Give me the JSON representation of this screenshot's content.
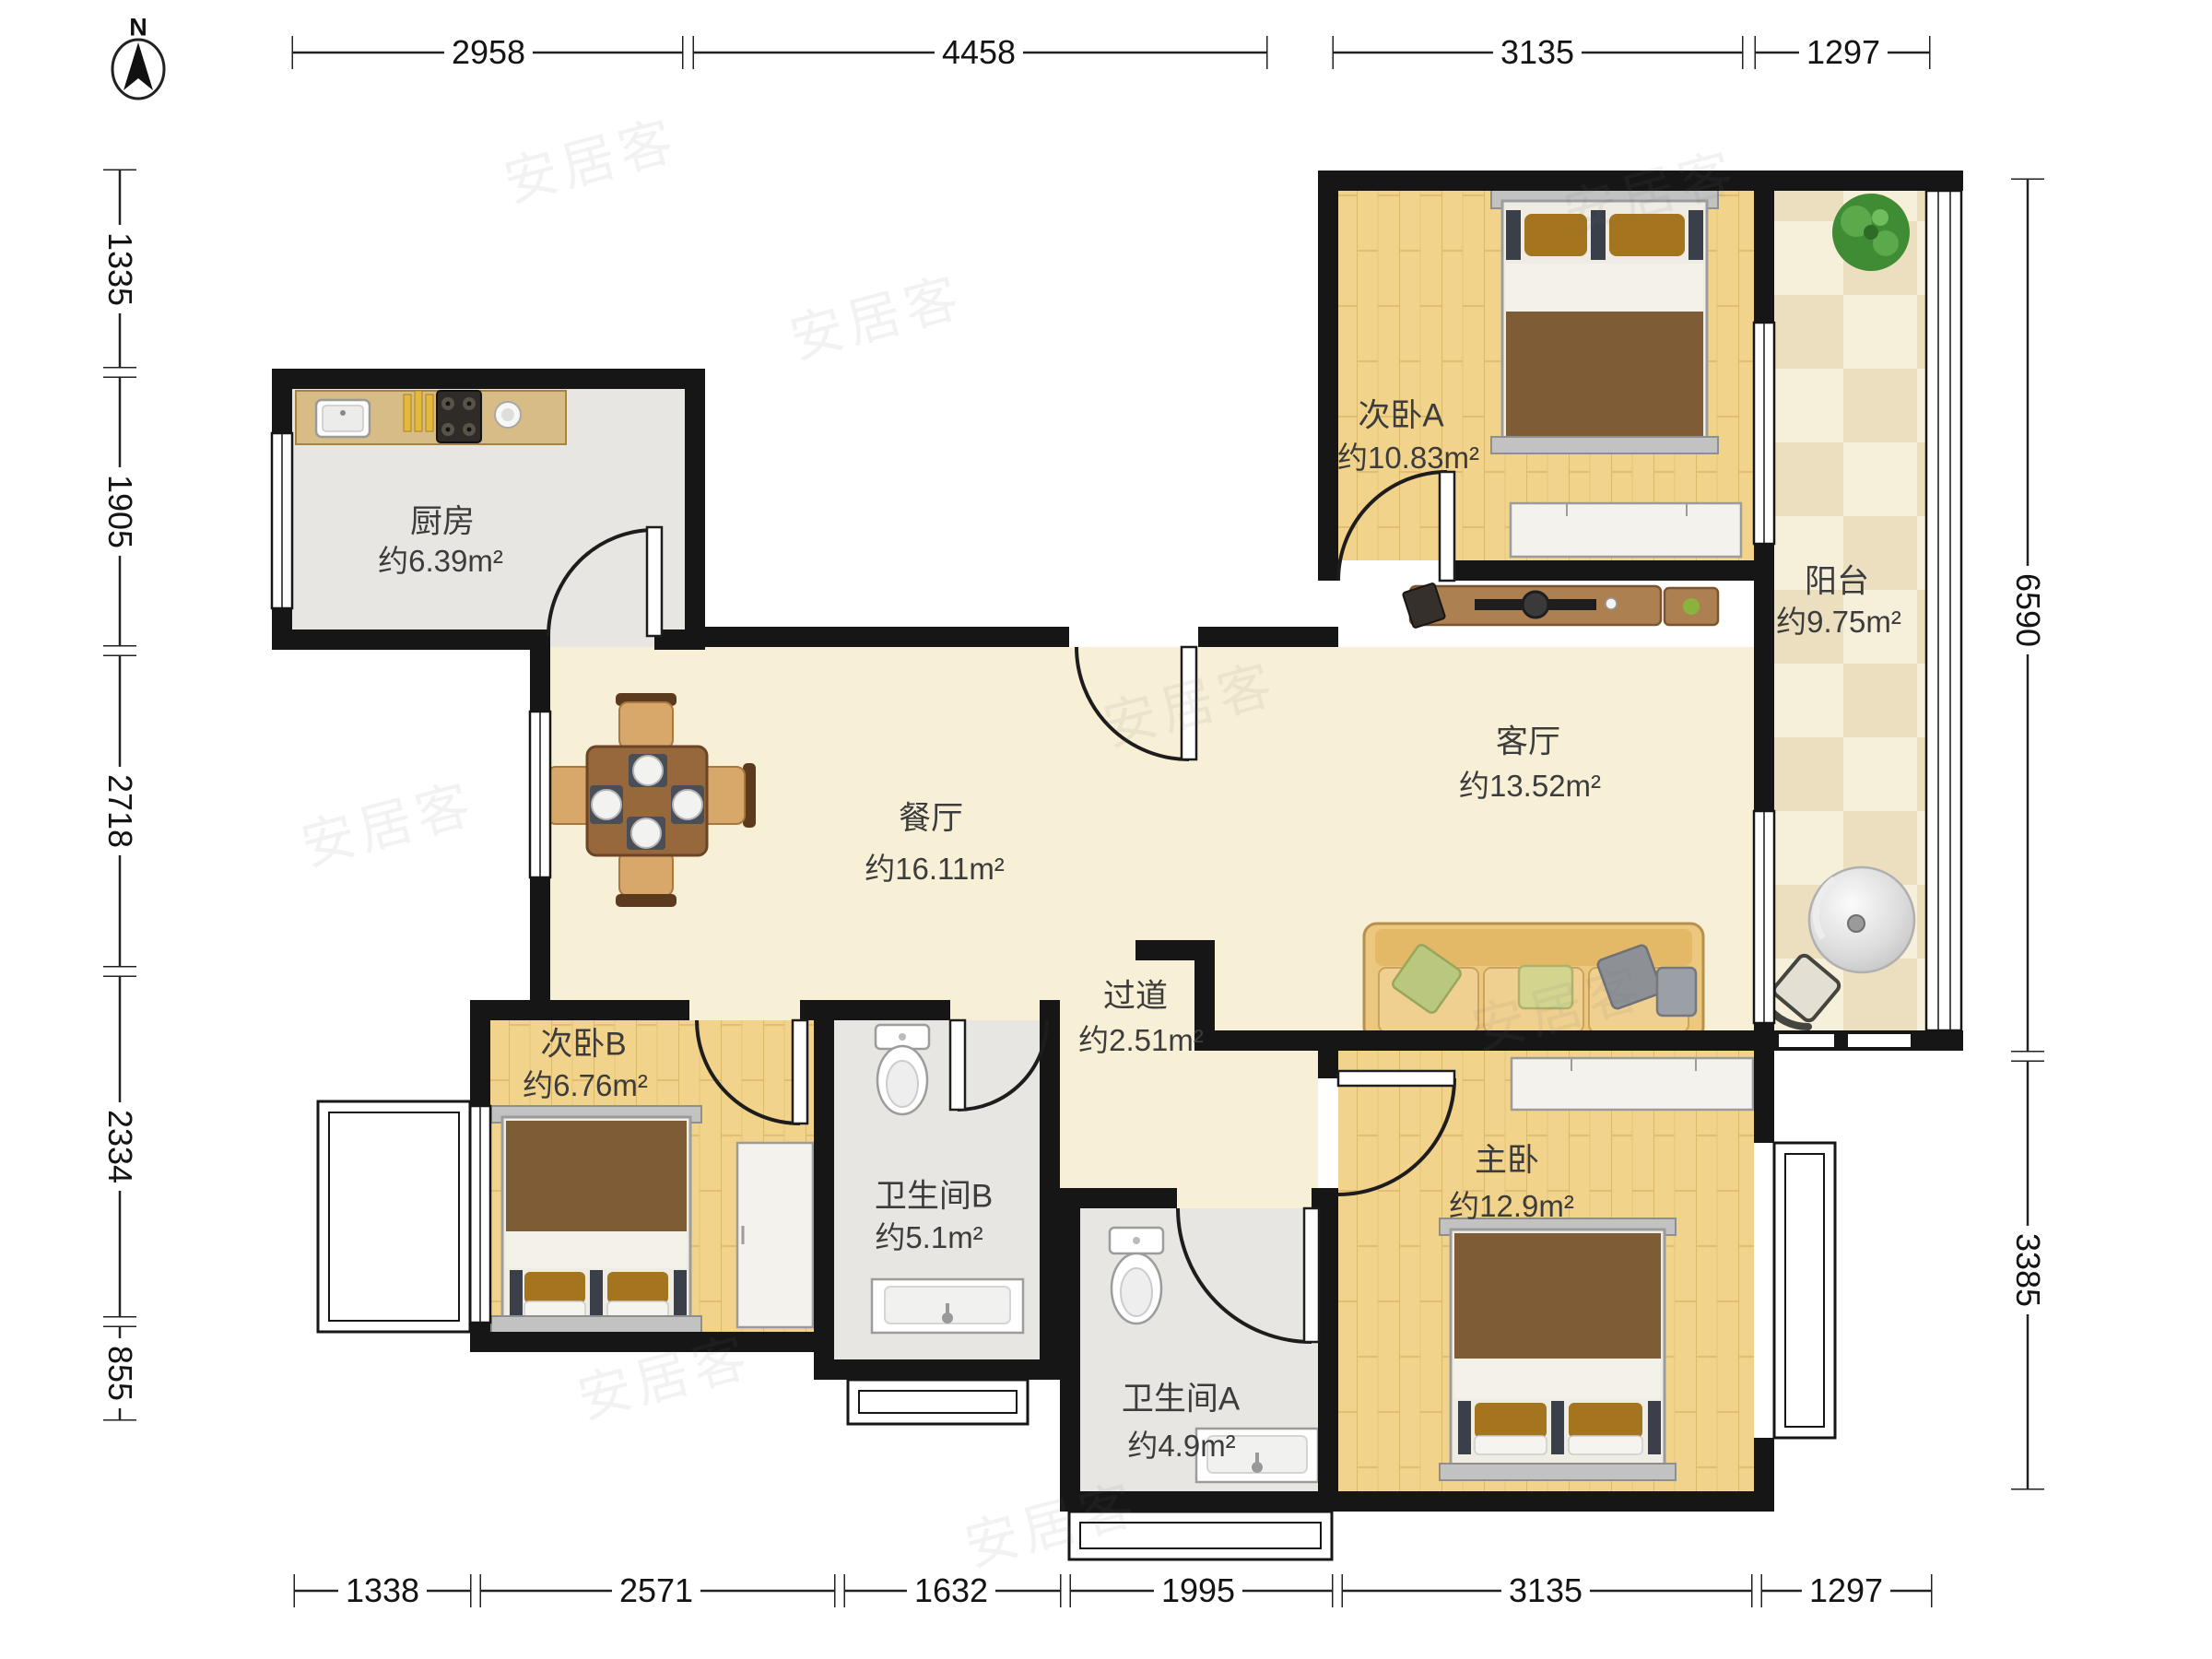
{
  "compass": {
    "label": "N"
  },
  "watermark": {
    "text": "安居客"
  },
  "rooms": [
    {
      "id": "kitchen",
      "name": "厨房",
      "area": "约6.39m²"
    },
    {
      "id": "bedroom_a",
      "name": "次卧A",
      "area": "约10.83m²"
    },
    {
      "id": "balcony",
      "name": "阳台",
      "area": "约9.75m²"
    },
    {
      "id": "dining",
      "name": "餐厅",
      "area": "约16.11m²"
    },
    {
      "id": "living",
      "name": "客厅",
      "area": "约13.52m²"
    },
    {
      "id": "hallway",
      "name": "过道",
      "area": "约2.51m²"
    },
    {
      "id": "bedroom_b",
      "name": "次卧B",
      "area": "约6.76m²"
    },
    {
      "id": "bathroom_b",
      "name": "卫生间B",
      "area": "约5.1m²"
    },
    {
      "id": "bathroom_a",
      "name": "卫生间A",
      "area": "约4.9m²"
    },
    {
      "id": "master",
      "name": "主卧",
      "area": "约12.9m²"
    }
  ],
  "dimensions": {
    "top": [
      "2958",
      "4458",
      "3135",
      "1297"
    ],
    "bottom": [
      "1338",
      "2571",
      "1632",
      "1995",
      "3135",
      "1297"
    ],
    "left": [
      "1335",
      "1905",
      "2718",
      "2334",
      "855"
    ],
    "right": [
      "6590",
      "3385"
    ]
  },
  "colors": {
    "wall": "#161616",
    "wood_floor": "#f2d38b",
    "marble_floor": "#f8f0d6",
    "tile_gray": "#e7e6e3",
    "balcony_tile": "#f6efd9",
    "counter": "#d7bd85",
    "blanket": "#7d5c36",
    "sofa": "#ecc77e",
    "plant": "#3f8c34"
  }
}
